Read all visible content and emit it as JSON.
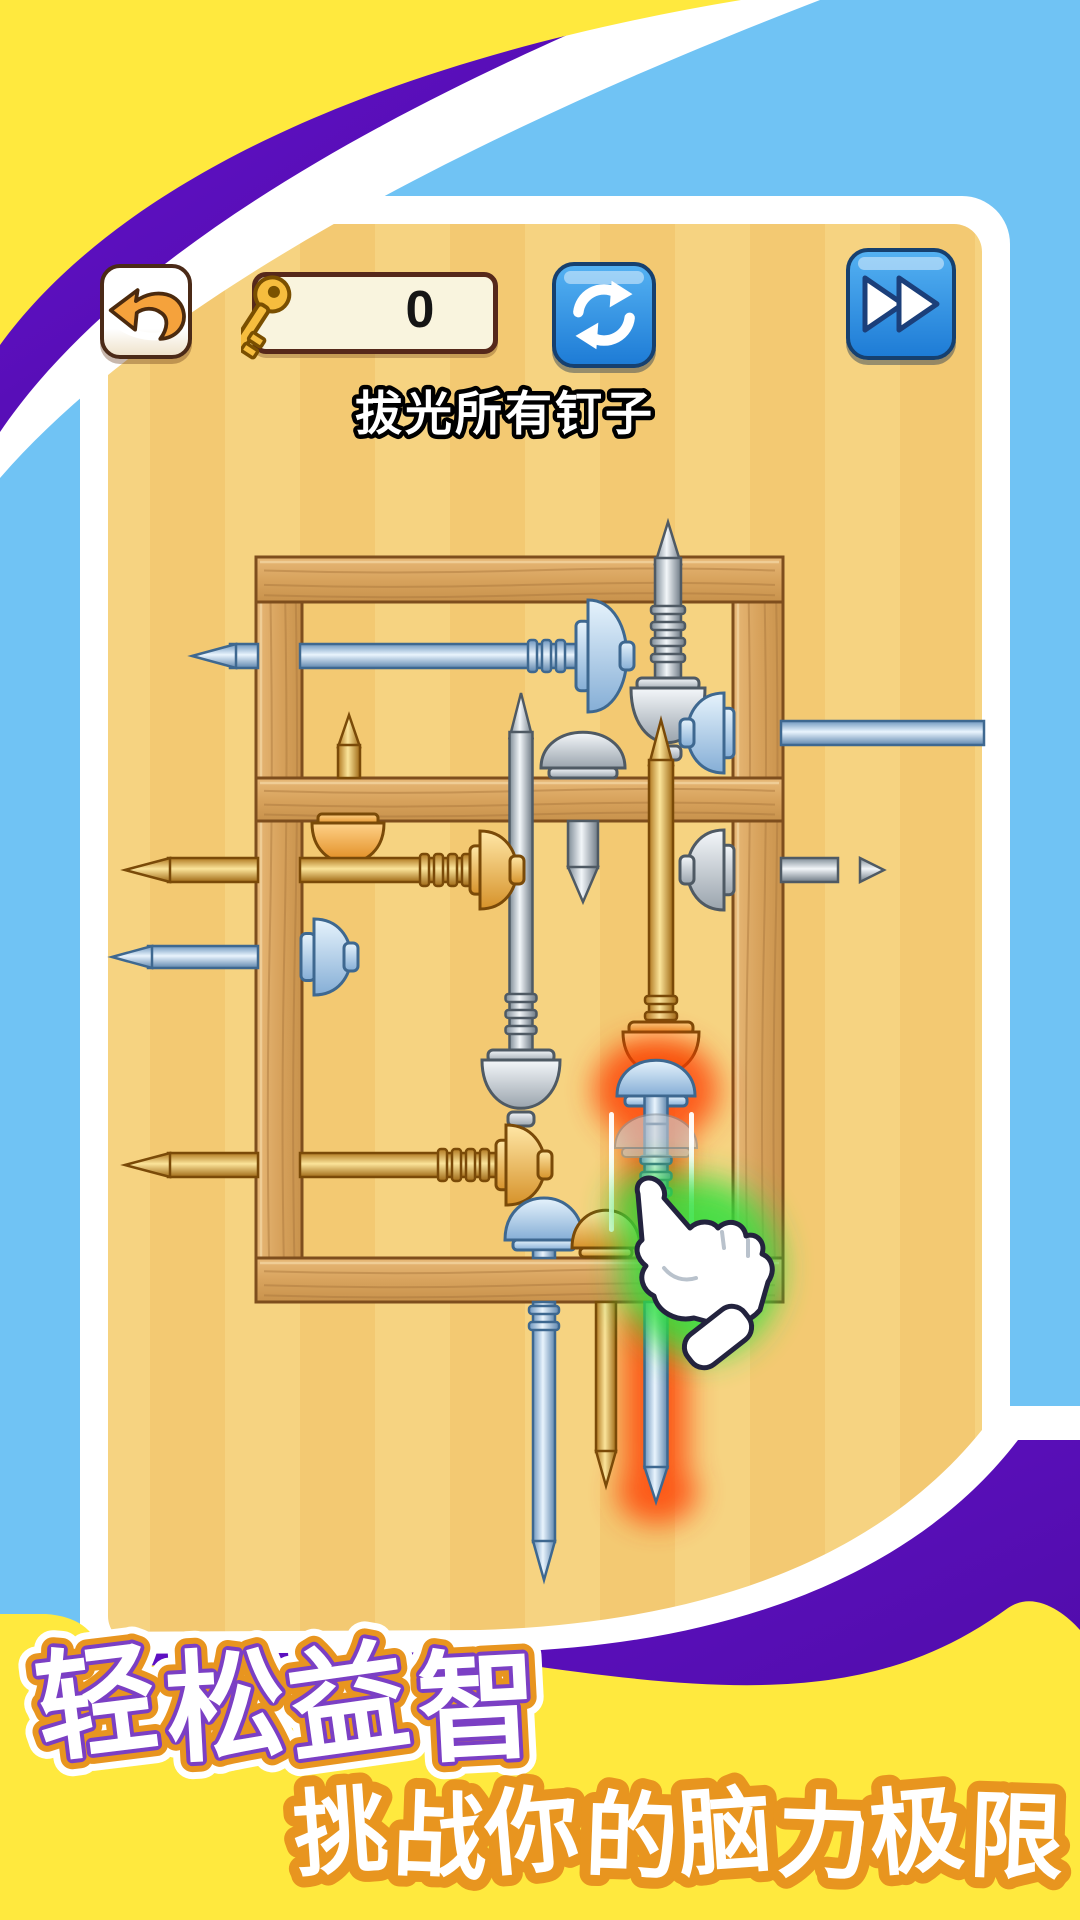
{
  "header": {
    "back": {
      "label": "back"
    },
    "key_counter": {
      "value": "0",
      "icon": "key-icon"
    },
    "refresh": {
      "icon": "refresh-icon"
    },
    "forward": {
      "icon": "fast-forward-icon"
    }
  },
  "objective": {
    "text": "拔光所有钉子"
  },
  "banner": {
    "line1": {
      "text": "轻松益智",
      "fill": "#FFFFFF",
      "stroke_inner": "#7B3FC4",
      "stroke_mid": "#E8951F",
      "stroke_outer": "#FFFFFF"
    },
    "line2": {
      "text": "挑战你的脑力极限",
      "fill": "#FFFFFF",
      "stroke": "#E8951F"
    }
  },
  "palette": {
    "bg_blue": "#70C3F4",
    "bg_yellow": "#FFE93E",
    "ribbon_purple": "#5A0CBE",
    "ribbon_white": "#FFFFFF",
    "panel_tan": "#F3C972",
    "panel_tan_light": "#F6D381",
    "wood_outline": "#7E4E1D",
    "glow_red": "#FF3A00",
    "glow_green": "#2FE03C"
  },
  "puzzle": {
    "frame": {
      "beams": [
        {
          "name": "left-beam",
          "x": 256,
          "y": 557,
          "w": 46,
          "h": 745,
          "grain": "v"
        },
        {
          "name": "right-beam",
          "x": 733,
          "y": 557,
          "w": 50,
          "h": 745,
          "grain": "v"
        },
        {
          "name": "top-beam",
          "x": 256,
          "y": 557,
          "w": 527,
          "h": 45,
          "grain": "h"
        },
        {
          "name": "middle-beam",
          "x": 256,
          "y": 778,
          "w": 527,
          "h": 43,
          "grain": "h"
        },
        {
          "name": "bottom-beam",
          "x": 256,
          "y": 1258,
          "w": 527,
          "h": 44,
          "grain": "h"
        }
      ]
    },
    "nails": [
      {
        "id": "nail-blue-top-left",
        "color": "blue",
        "kind": "h",
        "dir": "left",
        "cy": 656,
        "tip": 192,
        "taper": 44,
        "th": 24,
        "shaft": [
          [
            230,
            258
          ],
          [
            300,
            578
          ]
        ],
        "ribs": [
          528,
          578
        ],
        "rim_x": 576,
        "dome": {
          "x": 588,
          "w": 38,
          "h": 112
        },
        "nub": true
      },
      {
        "id": "nail-silver-top",
        "color": "silver",
        "kind": "v-up",
        "cx": 668,
        "tip": 522,
        "taper": 42,
        "th": 26,
        "shaft": [
          [
            558,
            686
          ]
        ],
        "ribs": [
          606,
          662
        ],
        "head": {
          "w": 74,
          "h": 52,
          "y": 686
        }
      },
      {
        "id": "nail-silver-center",
        "color": "silver",
        "kind": "v-up",
        "cx": 521,
        "tip": 693,
        "taper": 45,
        "th": 23,
        "shaft": [
          [
            732,
            1058
          ]
        ],
        "ribs": [
          994,
          1044
        ],
        "head": {
          "w": 78,
          "h": 46,
          "y": 1058
        }
      },
      {
        "id": "nail-gold-tall",
        "color": "gold",
        "tone": "orange",
        "kind": "v-up",
        "cx": 661,
        "tip": 720,
        "taper": 45,
        "th": 24,
        "shaft": [
          [
            760,
            1030
          ]
        ],
        "ribs": [
          996,
          1028
        ],
        "head": {
          "w": 76,
          "h": 40,
          "y": 1030
        }
      },
      {
        "id": "nail-gold-tip-upper",
        "color": "gold",
        "kind": "v-tip",
        "cx": 349,
        "tip": 715,
        "taper": 32,
        "th": 22,
        "to": 778
      },
      {
        "id": "nail-silver-short-down",
        "color": "silver",
        "kind": "cap-tip",
        "cx": 583,
        "cap": {
          "w": 84,
          "h": 34,
          "base": 768,
          "rim_h": 10
        },
        "tip_from": 821,
        "tip_to": 868,
        "apex": 902,
        "th": 30
      },
      {
        "id": "nail-gold-under-beam",
        "color": "gold",
        "tone": "orange",
        "kind": "v-head-only",
        "cx": 348,
        "head": {
          "w": 72,
          "h": 38,
          "y": 820
        }
      },
      {
        "id": "nail-gold-left-upper",
        "color": "gold",
        "kind": "h",
        "dir": "left",
        "cy": 870,
        "tip": 125,
        "taper": 45,
        "th": 24,
        "shaft": [
          [
            168,
            258
          ],
          [
            300,
            472
          ]
        ],
        "ribs": [
          420,
          472
        ],
        "rim_x": 470,
        "dome": {
          "x": 480,
          "w": 36,
          "h": 78
        },
        "nub": true
      },
      {
        "id": "nail-blue-left-mid",
        "color": "blue",
        "kind": "h",
        "dir": "left",
        "cy": 957,
        "tip": 112,
        "taper": 40,
        "th": 22,
        "shaft": [
          [
            148,
            258
          ]
        ],
        "rim_x": 301,
        "dome": {
          "x": 314,
          "w": 36,
          "h": 76
        },
        "nub": true
      },
      {
        "id": "nail-gold-left-lower",
        "color": "gold",
        "kind": "h",
        "dir": "left",
        "cy": 1165,
        "tip": 125,
        "taper": 45,
        "th": 24,
        "shaft": [
          [
            168,
            258
          ],
          [
            300,
            498
          ]
        ],
        "ribs": [
          438,
          498
        ],
        "rim_x": 496,
        "dome": {
          "x": 506,
          "w": 38,
          "h": 80
        },
        "nub": true
      },
      {
        "id": "nail-blue-right",
        "color": "blue",
        "kind": "h",
        "dir": "right",
        "cy": 733,
        "th": 24,
        "shaft": [
          [
            781,
            984
          ]
        ],
        "rim_x": 734,
        "dome": {
          "x": 688,
          "w": 36,
          "h": 80
        },
        "nub": true
      },
      {
        "id": "nail-silver-right",
        "color": "silver",
        "kind": "h",
        "dir": "right",
        "cy": 870,
        "th": 24,
        "shaft": [
          [
            781,
            838
          ]
        ],
        "tip": 860,
        "rim_x": 734,
        "dome": {
          "x": 688,
          "w": 36,
          "h": 80
        },
        "nub": true
      },
      {
        "id": "nail-blue-small",
        "color": "blue",
        "kind": "v-down",
        "cx": 544,
        "cap": {
          "w": 78,
          "h": 40,
          "top": 1200
        },
        "rim_h": 10,
        "th": 22,
        "shaft": [
          [
            1250,
            1258
          ],
          [
            1302,
            1542
          ]
        ],
        "ribs": [
          1306,
          1338
        ],
        "tip_apex": 1580
      },
      {
        "id": "nail-gold-small",
        "color": "gold",
        "kind": "v-down",
        "cx": 606,
        "cap": {
          "w": 68,
          "h": 36,
          "top": 1212
        },
        "rim_h": 9,
        "th": 20,
        "shaft": [
          [
            1257,
            1258
          ],
          [
            1302,
            1452
          ]
        ],
        "ribs": null,
        "tip_apex": 1486
      },
      {
        "id": "nail-blue-highlight",
        "color": "blue",
        "kind": "v-down",
        "highlight": true,
        "cx": 656,
        "cap": {
          "w": 78,
          "h": 34,
          "top": 1062
        },
        "rim_h": 10,
        "neck": [
          1096,
          1124
        ],
        "th": 23,
        "shaft": [
          [
            1124,
            1258
          ],
          [
            1302,
            1468
          ]
        ],
        "ribs": [
          1156,
          1240
        ],
        "tip_apex": 1502
      }
    ],
    "effects": {
      "red_glow": {
        "shapes": [
          {
            "cx": 656,
            "cy": 1090,
            "rx": 62,
            "ry": 52
          },
          {
            "x": 626,
            "y": 1092,
            "w": 60,
            "h": 166,
            "r": 26
          },
          {
            "x": 624,
            "y": 1300,
            "w": 64,
            "h": 186,
            "r": 28
          },
          {
            "cx": 657,
            "cy": 1492,
            "rx": 40,
            "ry": 32
          }
        ]
      },
      "green_glow": {
        "shapes": [
          {
            "cx": 700,
            "cy": 1268,
            "rx": 80,
            "ry": 90
          },
          {
            "cx": 656,
            "cy": 1210,
            "rx": 44,
            "ry": 40
          }
        ]
      },
      "ghost_head": {
        "cx": 656,
        "cap_w": 82,
        "cap_h": 32,
        "top": 1116,
        "rim_h": 9
      },
      "pull_lines": [
        {
          "x": 609,
          "y": 1112,
          "h": 120
        },
        {
          "x": 689,
          "y": 1112,
          "h": 128
        }
      ]
    },
    "hand": {
      "present": true
    }
  }
}
